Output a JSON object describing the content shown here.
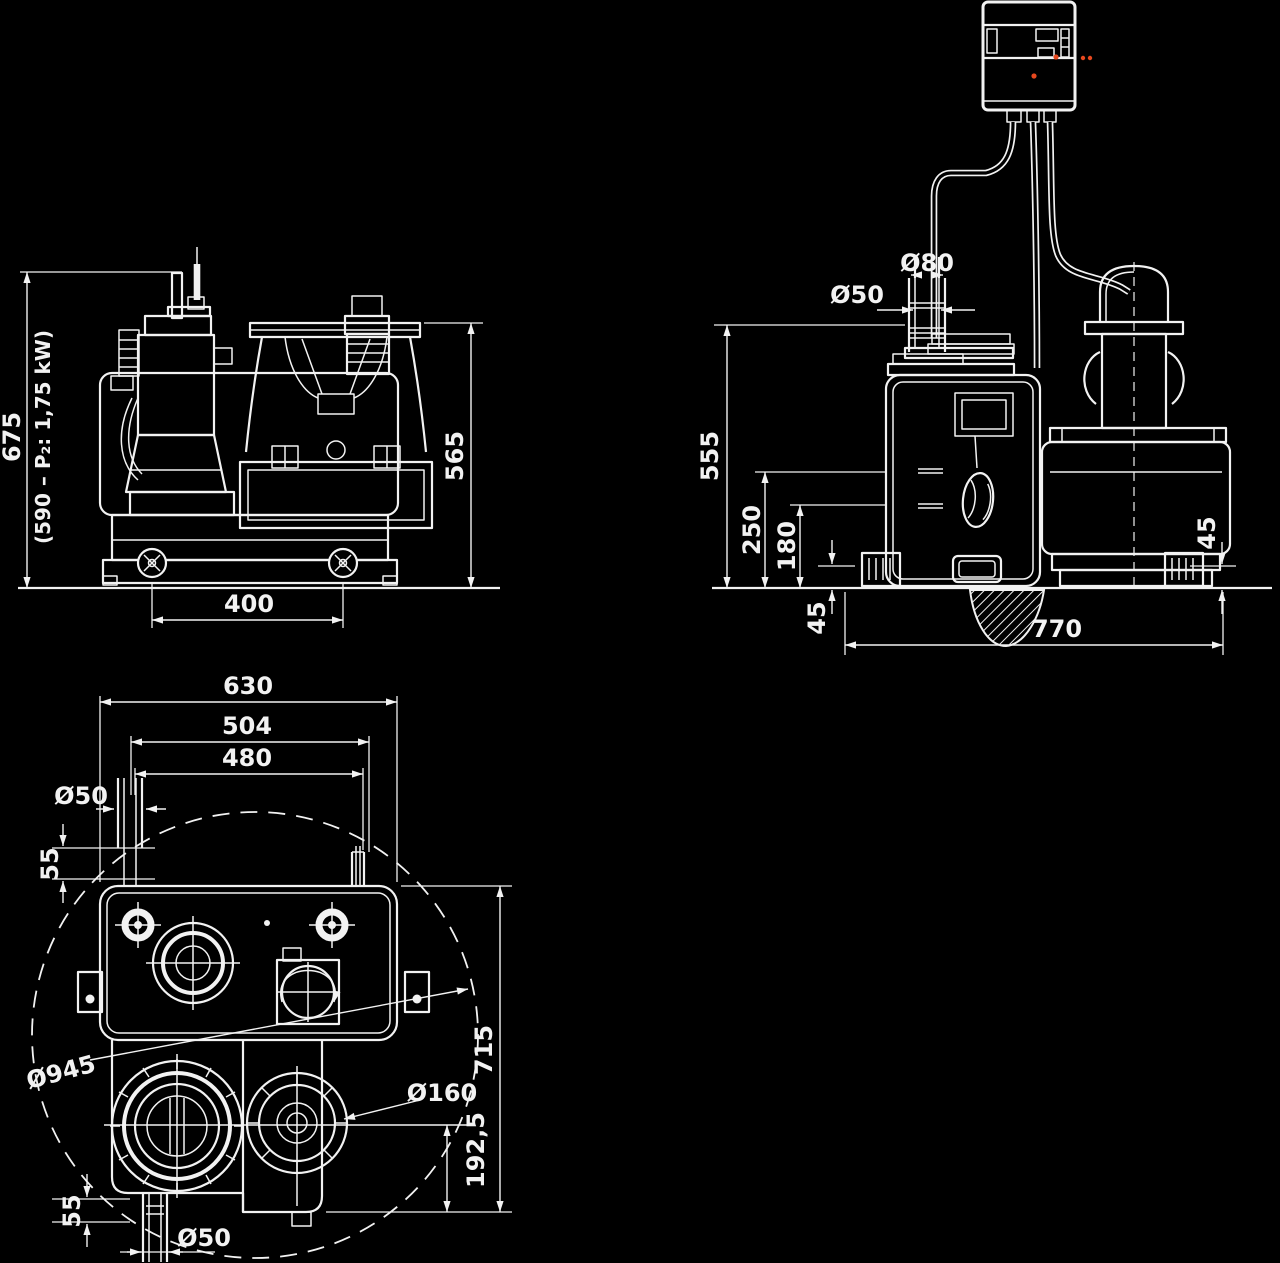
{
  "colors": {
    "background": "#000000",
    "line": "#f2f2f2",
    "accent_red": "#e6481e"
  },
  "front_view": {
    "height_total": "675",
    "height_note": "(590 – P₂: 1,75 kW)",
    "height_tank": "565",
    "wheel_spacing": "400"
  },
  "side_view": {
    "pipe_outer_diameter": "Ø80",
    "pipe_inner_diameter": "Ø50",
    "height_connection": "555",
    "height_inlet": "250",
    "height_drain": "180",
    "foot_hole_left": "45",
    "foot_hole_right": "45",
    "base_length": "770"
  },
  "plan_view": {
    "width_total": "630",
    "width_outer": "504",
    "width_inner": "480",
    "vent_pipe_diameter": "Ø50",
    "vent_offset": "55",
    "swing_circle_diameter": "Ø945",
    "motor_diameter": "Ø160",
    "depth_total": "715",
    "pump_axis_offset": "192,5",
    "drain_offset": "55",
    "drain_pipe_diameter": "Ø50"
  }
}
